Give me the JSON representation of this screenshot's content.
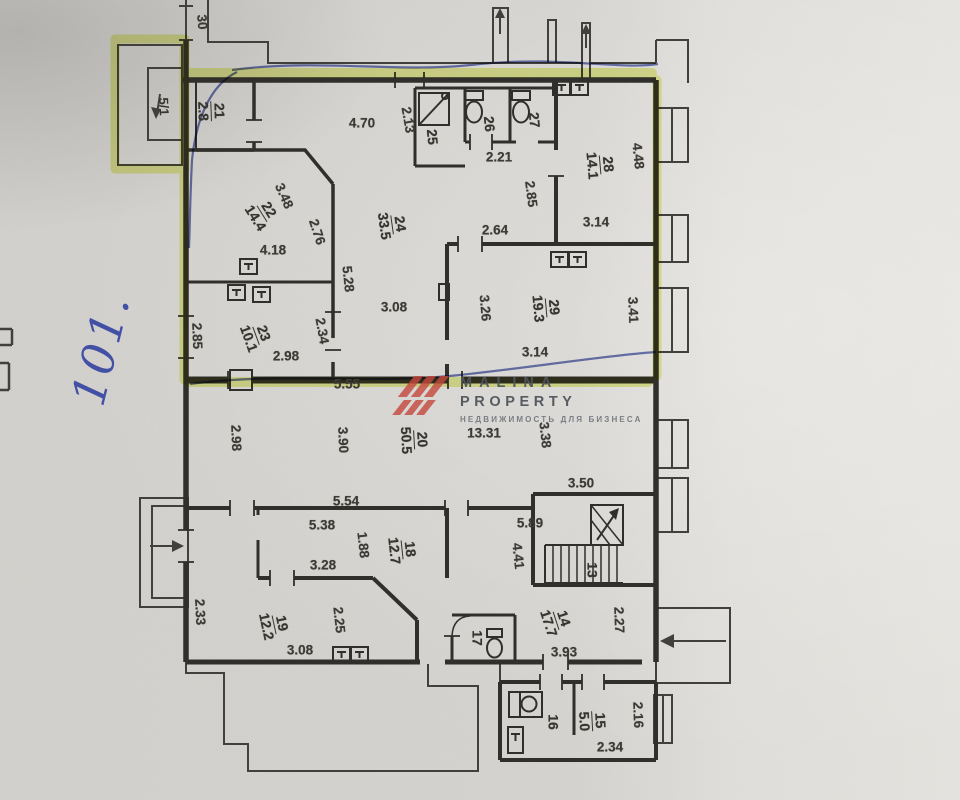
{
  "watermark": {
    "line1": "MALINA",
    "line2": "PROPERTY",
    "subtitle": "НЕДВИЖИМОСТЬ ДЛЯ БИЗНЕСА",
    "logo_color": "#c4463c",
    "text_color": "#4e545a"
  },
  "annotations": {
    "handwritten_number": "101.",
    "unit_box_label": "5/1",
    "ink_color": "#3d4fa5",
    "highlight_color": "#dce94c"
  },
  "rooms": [
    {
      "number": "21",
      "area": "2.8",
      "x": 211,
      "y": 111,
      "rot": 88
    },
    {
      "number": "22",
      "area": "14.4",
      "x": 262,
      "y": 214,
      "rot": 58
    },
    {
      "number": "23",
      "area": "10.1",
      "x": 256,
      "y": 336,
      "rot": 70
    },
    {
      "number": "24",
      "area": "33.5",
      "x": 392,
      "y": 225,
      "rot": 82
    },
    {
      "number": "25",
      "area": null,
      "x": 432,
      "y": 137,
      "rot": 85
    },
    {
      "number": "26",
      "area": null,
      "x": 489,
      "y": 124,
      "rot": 85
    },
    {
      "number": "27",
      "area": null,
      "x": 534,
      "y": 120,
      "rot": 85
    },
    {
      "number": "28",
      "area": "14.1",
      "x": 600,
      "y": 165,
      "rot": 85
    },
    {
      "number": "29",
      "area": "19.3",
      "x": 546,
      "y": 308,
      "rot": 85
    },
    {
      "number": "20",
      "area": "50.5",
      "x": 414,
      "y": 440,
      "rot": 87
    },
    {
      "number": "18",
      "area": "12.7",
      "x": 402,
      "y": 550,
      "rot": 84
    },
    {
      "number": "19",
      "area": "12.2",
      "x": 274,
      "y": 625,
      "rot": 78
    },
    {
      "number": "17",
      "area": null,
      "x": 477,
      "y": 638,
      "rot": 90
    },
    {
      "number": "13",
      "area": null,
      "x": 592,
      "y": 570,
      "rot": 90
    },
    {
      "number": "14",
      "area": "17.7",
      "x": 556,
      "y": 621,
      "rot": 72
    },
    {
      "number": "15",
      "area": "5.0",
      "x": 592,
      "y": 721,
      "rot": 87
    },
    {
      "number": "16",
      "area": null,
      "x": 553,
      "y": 722,
      "rot": 90
    }
  ],
  "dimensions": [
    {
      "text": "30",
      "x": 202,
      "y": 22,
      "rot": 85
    },
    {
      "text": "4.70",
      "x": 362,
      "y": 123,
      "rot": 0
    },
    {
      "text": "2.13",
      "x": 408,
      "y": 120,
      "rot": 80
    },
    {
      "text": "2.21",
      "x": 499,
      "y": 157,
      "rot": 0
    },
    {
      "text": "2.85",
      "x": 531,
      "y": 194,
      "rot": 83
    },
    {
      "text": "2.64",
      "x": 495,
      "y": 230,
      "rot": 0
    },
    {
      "text": "3.14",
      "x": 596,
      "y": 222,
      "rot": 0
    },
    {
      "text": "4.48",
      "x": 638,
      "y": 156,
      "rot": 84
    },
    {
      "text": "3.48",
      "x": 284,
      "y": 196,
      "rot": 66
    },
    {
      "text": "2.76",
      "x": 317,
      "y": 232,
      "rot": 72
    },
    {
      "text": "4.18",
      "x": 273,
      "y": 250,
      "rot": 0
    },
    {
      "text": "5.28",
      "x": 348,
      "y": 279,
      "rot": 84
    },
    {
      "text": "2.34",
      "x": 322,
      "y": 331,
      "rot": 80
    },
    {
      "text": "2.85",
      "x": 197,
      "y": 336,
      "rot": 88
    },
    {
      "text": "2.98",
      "x": 286,
      "y": 356,
      "rot": 0
    },
    {
      "text": "3.08",
      "x": 394,
      "y": 307,
      "rot": 0
    },
    {
      "text": "3.26",
      "x": 485,
      "y": 308,
      "rot": 85
    },
    {
      "text": "3.41",
      "x": 633,
      "y": 310,
      "rot": 88
    },
    {
      "text": "3.14",
      "x": 535,
      "y": 352,
      "rot": 0
    },
    {
      "text": "5.55",
      "x": 347,
      "y": 384,
      "rot": 0
    },
    {
      "text": "2.98",
      "x": 236,
      "y": 438,
      "rot": 88
    },
    {
      "text": "3.90",
      "x": 343,
      "y": 440,
      "rot": 88
    },
    {
      "text": "13.31",
      "x": 484,
      "y": 433,
      "rot": 0
    },
    {
      "text": "3.38",
      "x": 545,
      "y": 435,
      "rot": 84
    },
    {
      "text": "3.50",
      "x": 581,
      "y": 483,
      "rot": 0
    },
    {
      "text": "5.54",
      "x": 346,
      "y": 501,
      "rot": 0
    },
    {
      "text": "5.38",
      "x": 322,
      "y": 525,
      "rot": 0
    },
    {
      "text": "1.88",
      "x": 363,
      "y": 545,
      "rot": 84
    },
    {
      "text": "3.28",
      "x": 323,
      "y": 565,
      "rot": 0
    },
    {
      "text": "5.89",
      "x": 530,
      "y": 523,
      "rot": 0
    },
    {
      "text": "4.41",
      "x": 518,
      "y": 556,
      "rot": 84
    },
    {
      "text": "2.25",
      "x": 339,
      "y": 620,
      "rot": 84
    },
    {
      "text": "2.33",
      "x": 200,
      "y": 612,
      "rot": 87
    },
    {
      "text": "3.08",
      "x": 300,
      "y": 650,
      "rot": 0
    },
    {
      "text": "2.27",
      "x": 619,
      "y": 620,
      "rot": 88
    },
    {
      "text": "3.93",
      "x": 564,
      "y": 652,
      "rot": 0
    },
    {
      "text": "2.16",
      "x": 638,
      "y": 715,
      "rot": 88
    },
    {
      "text": "2.34",
      "x": 610,
      "y": 747,
      "rot": 0
    }
  ]
}
